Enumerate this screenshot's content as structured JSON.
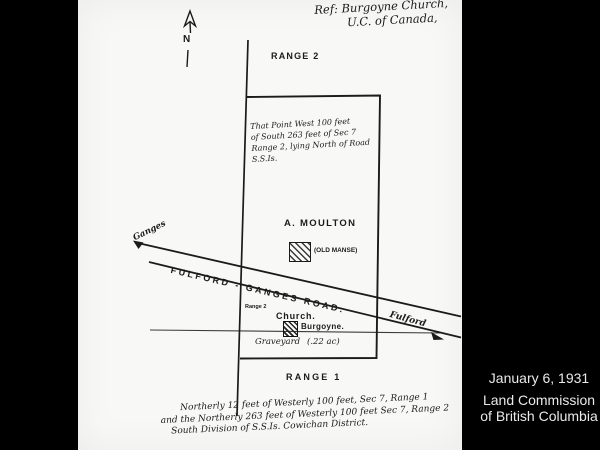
{
  "slide": {
    "caption": {
      "date": "January 6, 1931",
      "org_line1": "Land Commission",
      "org_line2": "of British Columbia"
    }
  },
  "map": {
    "ref_note_line1": "Ref: Burgoyne Church,",
    "ref_note_line2": "U.C. of Canada,",
    "north_label": "N",
    "range2_label": "RANGE 2",
    "range1_label": "RANGE 1",
    "parcel_note": [
      "That Point West 100 feet",
      "of South 263 feet of Sec 7",
      "Range 2, lying North of Road",
      "S.S.Is."
    ],
    "owner_label": "A. MOULTON",
    "old_manse_label": "(OLD MANSE)",
    "road_label": "FULFORD - GANGES ROAD.",
    "ganges_label": "Ganges",
    "fulford_label": "Fulford",
    "range2_small_label": "Range 2",
    "church_label": "Church.",
    "burgoyne_label": "Burgoyne.",
    "graveyard_label": "Graveyard",
    "area_label": "(.22 ac)",
    "bottom_note": [
      "Northerly 12 feet of Westerly 100 feet, Sec 7, Range 1",
      "and the Northerly 263 feet of Westerly 100 feet Sec 7, Range 2",
      "South Division of S.S.Is. Cowichan District."
    ]
  },
  "icons": {
    "north_arrow": "north-arrow",
    "ganges_arrow": "road-direction-arrow",
    "fulford_arrow": "road-direction-arrow"
  },
  "colors": {
    "background": "#000000",
    "paper": "#f8f8f6",
    "ink": "#1b1b1b",
    "caption_text": "#e9e9e9"
  }
}
